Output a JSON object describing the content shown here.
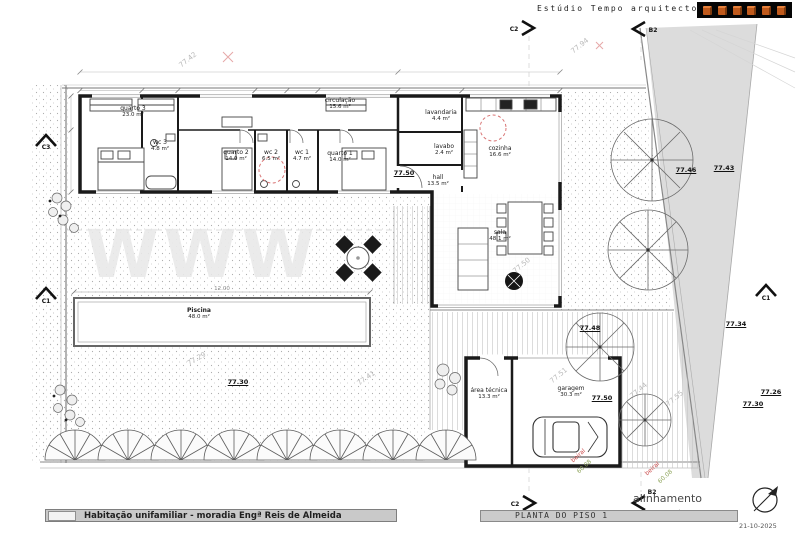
{
  "studio": "Estúdio Tempo arquitectos",
  "watermark": "WWW",
  "rooms": [
    {
      "name": "quarto 3",
      "area": "23.0 m²"
    },
    {
      "name": "wc 3",
      "area": "4.8 m²"
    },
    {
      "name": "quarto 2",
      "area": "14.0 m²"
    },
    {
      "name": "wc 2",
      "area": "6.5 m²"
    },
    {
      "name": "wc 1",
      "area": "4.7 m²"
    },
    {
      "name": "quarto 1",
      "area": "14.0 m²"
    },
    {
      "name": "circulação",
      "area": "15.6 m²"
    },
    {
      "name": "lavandaria",
      "area": "4.4 m²"
    },
    {
      "name": "lavabo",
      "area": "2.4 m²"
    },
    {
      "name": "cozinha",
      "area": "16.6 m²"
    },
    {
      "name": "hall",
      "area": "13.5 m²"
    },
    {
      "name": "sala",
      "area": "48.1 m²"
    },
    {
      "name": "Piscina",
      "area": "48.0 m²"
    },
    {
      "name": "área técnica",
      "area": "13.3 m²"
    },
    {
      "name": "garagem",
      "area": "30.3 m²"
    }
  ],
  "levels": [
    "77.50",
    "77.50",
    "77.48",
    "77.46",
    "77.43",
    "77.34",
    "77.30",
    "77.30",
    "77.26"
  ],
  "survey": [
    "77.42",
    "77.94",
    "77.29",
    "77.41",
    "77.50",
    "77.51",
    "77.44",
    "77.55"
  ],
  "notes_red": [
    "beiral",
    "beiral"
  ],
  "notes_green": [
    "60.08",
    "60.08"
  ],
  "markers": [
    "C2",
    "B2",
    "C3",
    "C1",
    "C1",
    "C2",
    "B2"
  ],
  "dims": {
    "pool_width": "12.00"
  },
  "footer": {
    "project": "Habitação unifamiliar - moradia Engª Reis de Almeida",
    "drawing": "PLANTA DO PISO 1",
    "alinhamento": "alinhamento",
    "date": "21-10-2025"
  }
}
